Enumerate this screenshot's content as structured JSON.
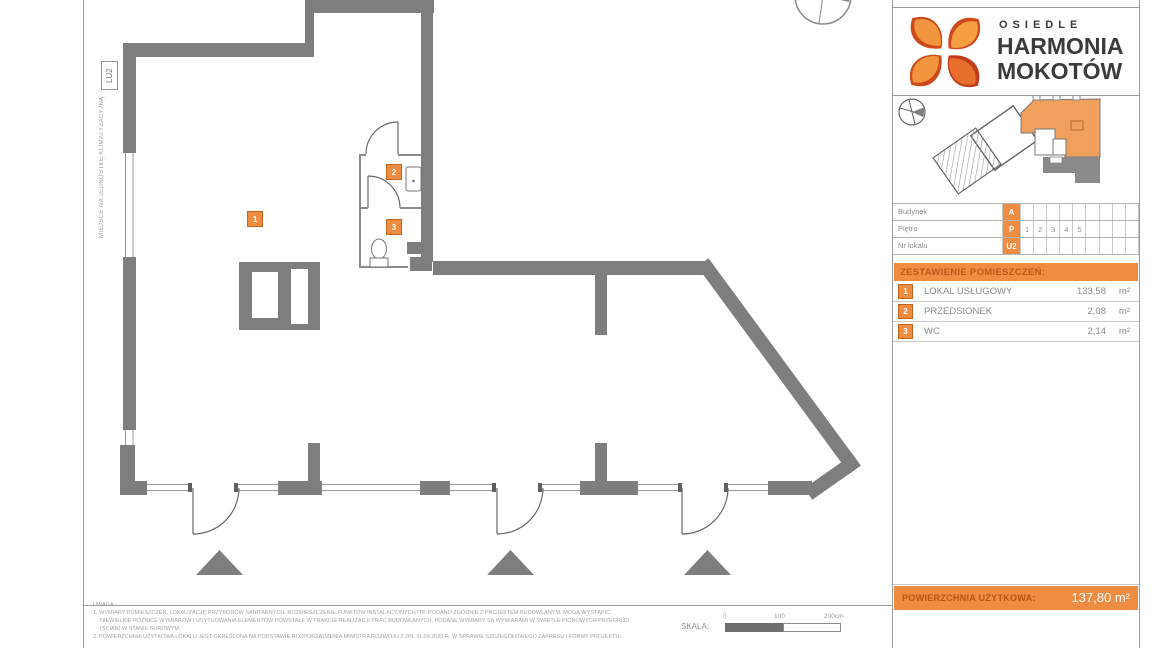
{
  "logo": {
    "line1": "OSIEDLE",
    "line2": "HARMONIA",
    "line3": "MOKOTÓW"
  },
  "plan": {
    "ac_label": "MIEJSCE NA JEDNOSTKĘ KLIMATYZACYJNĄ",
    "unit_tag": "LU2",
    "markers": [
      {
        "no": "1"
      },
      {
        "no": "2"
      },
      {
        "no": "3"
      }
    ]
  },
  "info_table": {
    "rows": [
      {
        "label": "Budynek",
        "code": "A",
        "cells": [
          "",
          "",
          "",
          "",
          "",
          "",
          "",
          "",
          ""
        ]
      },
      {
        "label": "Piętro",
        "code": "P",
        "cells": [
          "1",
          "2",
          "3",
          "4",
          "5",
          "",
          "",
          "",
          ""
        ]
      },
      {
        "label": "Nr lokalu",
        "code": "U2",
        "cells": [
          "",
          "",
          "",
          "",
          "",
          "",
          "",
          "",
          ""
        ]
      }
    ]
  },
  "rooms": {
    "header": "ZESTAWIENIE POMIESZCZEŃ:",
    "items": [
      {
        "no": "1",
        "name": "LOKAL USŁUGOWY",
        "area": "133,58",
        "unit": "m²"
      },
      {
        "no": "2",
        "name": "PRZEDSIONEK",
        "area": "2,08",
        "unit": "m²"
      },
      {
        "no": "3",
        "name": "WC",
        "area": "2,14",
        "unit": "m²"
      }
    ]
  },
  "footer": {
    "label": "POWIERZCHNIA UŻYTKOWA:",
    "value": "137,80 m²"
  },
  "notes": {
    "title": "UWAGA:",
    "lines": [
      "1. WYMIARY POMIESZCZEŃ, LOKALIZACJĘ PRZYBORÓW SANITARNYCH, ROZMIESZCZENIE PUNKTÓW INSTALACYJNYCH ITP. PODANO ZGODNIE Z PROJEKTEM BUDOWLANYM. MOGĄ WYSTĄPIĆ",
      "NIEWIELKIE RÓŻNICE WYMIARÓW I USYTUOWANIA ELEMENTÓW POWSTAŁE W TRAKCIE REALIZACJI PRAC BUDOWLANYCH. PODANE WYMIARY SĄ WYMIARAMI W ŚWIETLE PIONOWYCH PRZEGRÓD",
      "(ŚCIAN) W STANIE SUROWYM.",
      "2. POWIERZCHNIA UŻYTKOWA LOKALU JEST OKREŚLONA NA PODSTAWIE ROZPORZĄDZENIA MINISTRA ROZWOJU Z DN. 11.09.2020 R. W SPRAWIE SZCZEGÓŁOWEGO ZAKRESU I FORMY PROJEKTU..."
    ]
  },
  "scale": {
    "label": "SKALA:",
    "tick0": "0",
    "tick100": "100",
    "tick200": "200cm"
  },
  "colors": {
    "accent_orange": "#EE8C42",
    "wall_gray": "#7E7E7E"
  }
}
